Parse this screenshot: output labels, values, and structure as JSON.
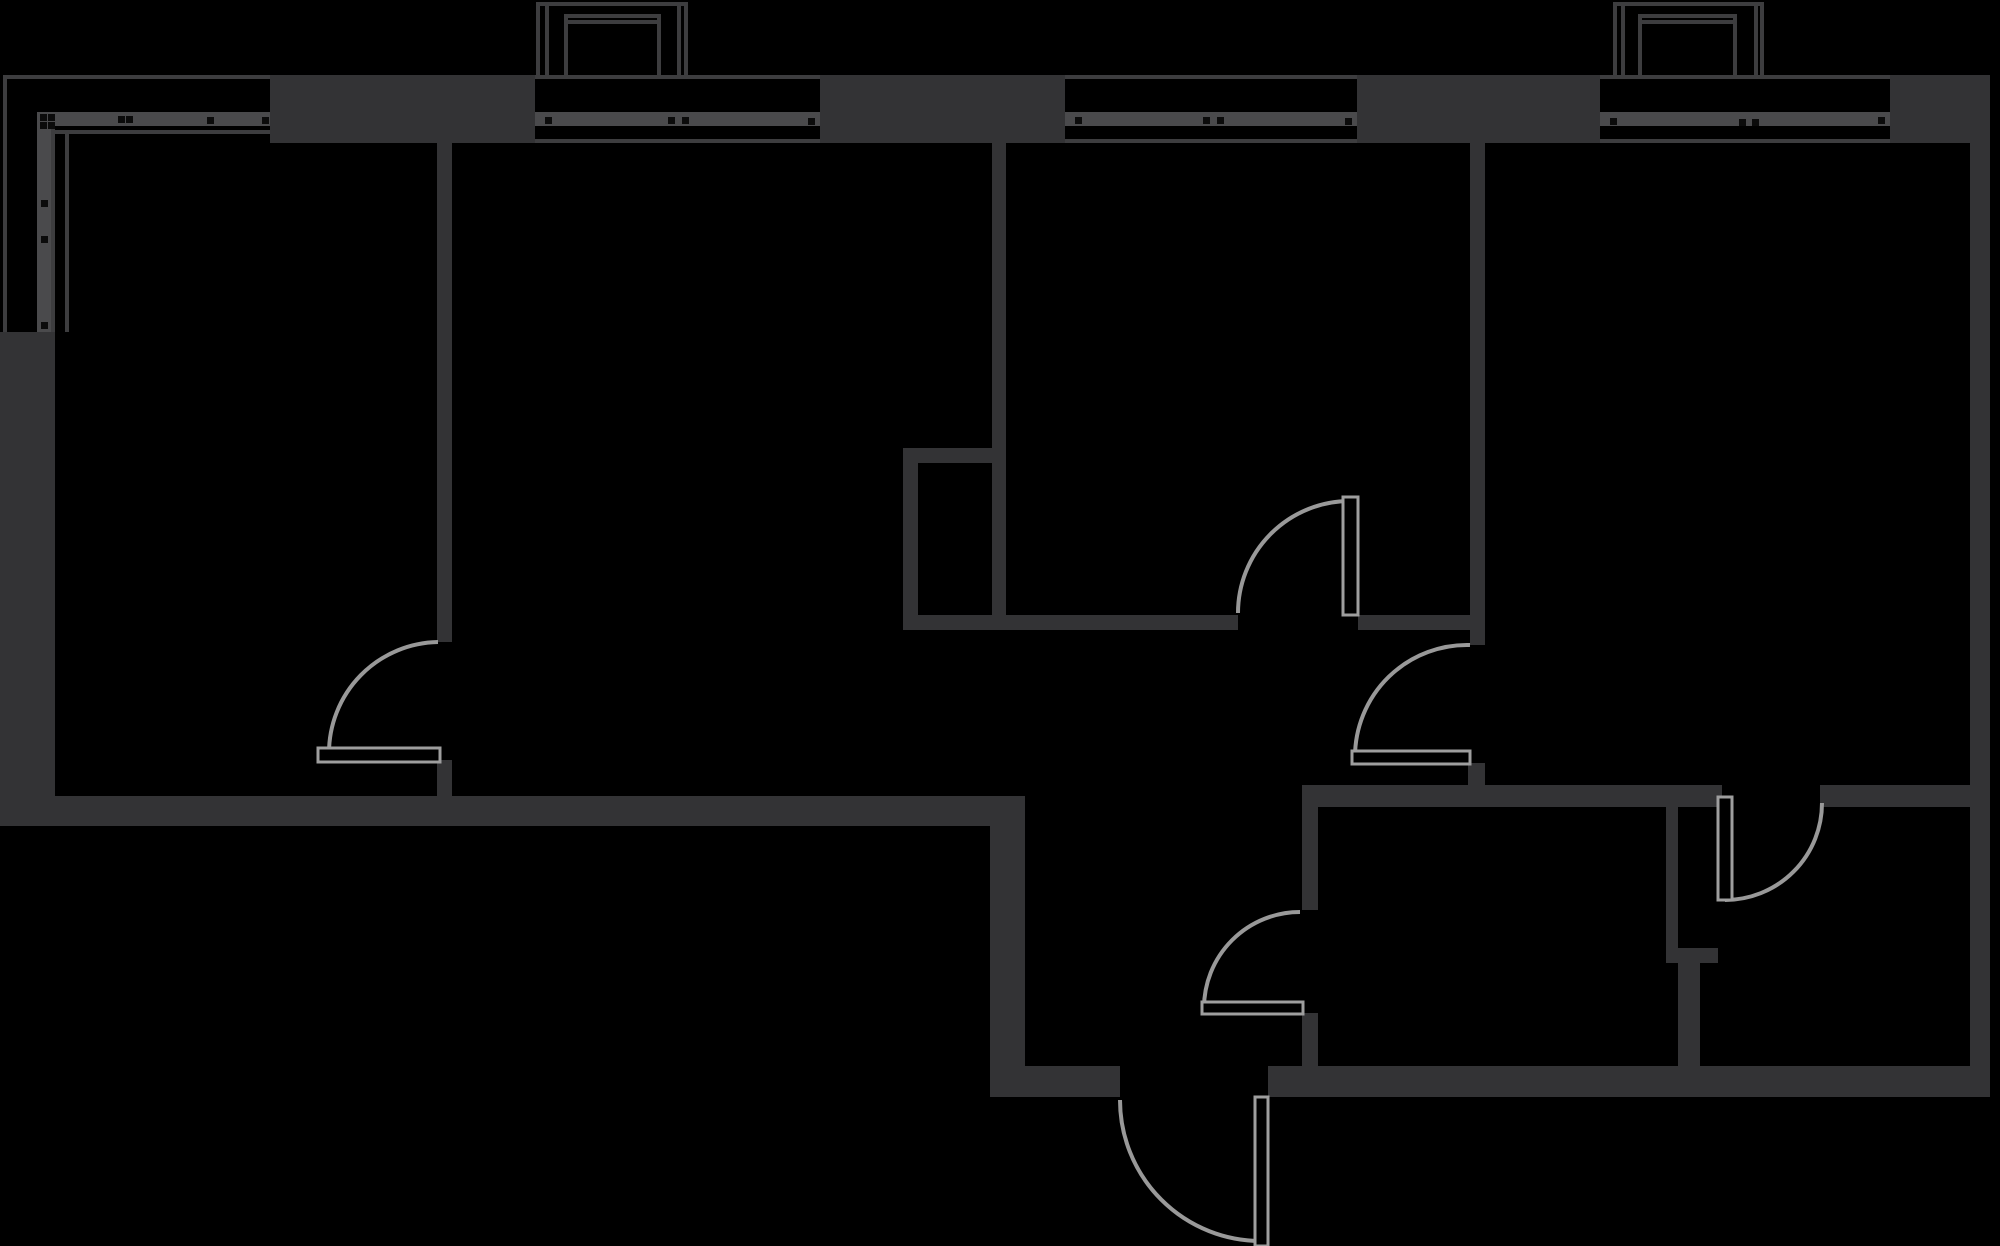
{
  "canvas": {
    "width": 2000,
    "height": 1246,
    "background": "#000000"
  },
  "palette": {
    "wall_fill": "#333335",
    "outline_line": "#3d3d3f",
    "glazing_bar": "#4a4a4c",
    "fixing_dot": "#0b0b0b",
    "door_symbol": "#9e9e9e",
    "door_arc": "#999999",
    "leaf_fill": "#000000"
  },
  "plan": {
    "outline_lines": [
      {
        "x": 3,
        "y": 75,
        "w": 1987,
        "h": 4
      },
      {
        "x": 3,
        "y": 75,
        "w": 4,
        "h": 257
      },
      {
        "x": 535,
        "y": 139,
        "w": 285,
        "h": 4
      },
      {
        "x": 1065,
        "y": 139,
        "w": 292,
        "h": 4
      },
      {
        "x": 1600,
        "y": 139,
        "w": 290,
        "h": 4
      },
      {
        "x": 51,
        "y": 130,
        "w": 219,
        "h": 4
      },
      {
        "x": 51,
        "y": 126,
        "w": 4,
        "h": 206
      },
      {
        "x": 65,
        "y": 134,
        "w": 4,
        "h": 198
      }
    ],
    "balcony_lines": [
      {
        "x": 536,
        "y": 2,
        "w": 152,
        "h": 4
      },
      {
        "x": 536,
        "y": 2,
        "w": 4,
        "h": 73
      },
      {
        "x": 545,
        "y": 2,
        "w": 4,
        "h": 73
      },
      {
        "x": 677,
        "y": 2,
        "w": 4,
        "h": 73
      },
      {
        "x": 684,
        "y": 2,
        "w": 4,
        "h": 73
      },
      {
        "x": 564,
        "y": 14,
        "w": 97,
        "h": 4
      },
      {
        "x": 564,
        "y": 20,
        "w": 97,
        "h": 4
      },
      {
        "x": 564,
        "y": 14,
        "w": 4,
        "h": 61
      },
      {
        "x": 657,
        "y": 14,
        "w": 4,
        "h": 61
      },
      {
        "x": 1613,
        "y": 2,
        "w": 151,
        "h": 4
      },
      {
        "x": 1613,
        "y": 2,
        "w": 4,
        "h": 73
      },
      {
        "x": 1621,
        "y": 2,
        "w": 4,
        "h": 73
      },
      {
        "x": 1754,
        "y": 2,
        "w": 4,
        "h": 73
      },
      {
        "x": 1760,
        "y": 2,
        "w": 4,
        "h": 73
      },
      {
        "x": 1638,
        "y": 14,
        "w": 99,
        "h": 4
      },
      {
        "x": 1638,
        "y": 20,
        "w": 99,
        "h": 4
      },
      {
        "x": 1638,
        "y": 14,
        "w": 4,
        "h": 61
      },
      {
        "x": 1733,
        "y": 14,
        "w": 4,
        "h": 61
      }
    ],
    "glazing_bars": [
      {
        "x": 37,
        "y": 112,
        "w": 233,
        "h": 14
      },
      {
        "x": 37,
        "y": 112,
        "w": 14,
        "h": 220
      },
      {
        "x": 535,
        "y": 112,
        "w": 285,
        "h": 14
      },
      {
        "x": 1065,
        "y": 112,
        "w": 292,
        "h": 14
      },
      {
        "x": 1600,
        "y": 112,
        "w": 290,
        "h": 14
      }
    ],
    "fixing_dots": [
      {
        "x": 40,
        "y": 114
      },
      {
        "x": 48,
        "y": 114
      },
      {
        "x": 40,
        "y": 122
      },
      {
        "x": 48,
        "y": 122
      },
      {
        "x": 118,
        "y": 116
      },
      {
        "x": 126,
        "y": 116
      },
      {
        "x": 207,
        "y": 117
      },
      {
        "x": 262,
        "y": 117
      },
      {
        "x": 41,
        "y": 200
      },
      {
        "x": 41,
        "y": 236
      },
      {
        "x": 41,
        "y": 322
      },
      {
        "x": 545,
        "y": 117
      },
      {
        "x": 668,
        "y": 117
      },
      {
        "x": 682,
        "y": 117
      },
      {
        "x": 808,
        "y": 118
      },
      {
        "x": 1075,
        "y": 117
      },
      {
        "x": 1203,
        "y": 117
      },
      {
        "x": 1217,
        "y": 117
      },
      {
        "x": 1345,
        "y": 118
      },
      {
        "x": 1610,
        "y": 118
      },
      {
        "x": 1739,
        "y": 119
      },
      {
        "x": 1752,
        "y": 119
      },
      {
        "x": 1878,
        "y": 117
      }
    ],
    "walls": [
      {
        "x": 0,
        "y": 332,
        "w": 55,
        "h": 494
      },
      {
        "x": 0,
        "y": 796,
        "w": 1025,
        "h": 30
      },
      {
        "x": 990,
        "y": 826,
        "w": 35,
        "h": 271
      },
      {
        "x": 270,
        "y": 75,
        "w": 265,
        "h": 68
      },
      {
        "x": 820,
        "y": 75,
        "w": 245,
        "h": 68
      },
      {
        "x": 1357,
        "y": 75,
        "w": 243,
        "h": 68
      },
      {
        "x": 1890,
        "y": 75,
        "w": 100,
        "h": 68
      },
      {
        "x": 437,
        "y": 143,
        "w": 15,
        "h": 499
      },
      {
        "x": 437,
        "y": 760,
        "w": 15,
        "h": 36
      },
      {
        "x": 992,
        "y": 143,
        "w": 14,
        "h": 487
      },
      {
        "x": 903,
        "y": 448,
        "w": 103,
        "h": 15
      },
      {
        "x": 903,
        "y": 448,
        "w": 15,
        "h": 182
      },
      {
        "x": 903,
        "y": 615,
        "w": 335,
        "h": 15
      },
      {
        "x": 1358,
        "y": 615,
        "w": 112,
        "h": 15
      },
      {
        "x": 1470,
        "y": 143,
        "w": 15,
        "h": 502
      },
      {
        "x": 1468,
        "y": 763,
        "w": 17,
        "h": 23
      },
      {
        "x": 1302,
        "y": 785,
        "w": 420,
        "h": 22
      },
      {
        "x": 1820,
        "y": 785,
        "w": 170,
        "h": 22
      },
      {
        "x": 1302,
        "y": 807,
        "w": 16,
        "h": 103
      },
      {
        "x": 1302,
        "y": 1013,
        "w": 16,
        "h": 53
      },
      {
        "x": 1666,
        "y": 807,
        "w": 12,
        "h": 141
      },
      {
        "x": 1666,
        "y": 948,
        "w": 52,
        "h": 15
      },
      {
        "x": 1678,
        "y": 963,
        "w": 22,
        "h": 103
      },
      {
        "x": 1025,
        "y": 1066,
        "w": 95,
        "h": 31
      },
      {
        "x": 1268,
        "y": 1066,
        "w": 722,
        "h": 31
      },
      {
        "x": 1970,
        "y": 75,
        "w": 20,
        "h": 1022
      }
    ],
    "door_leaves": [
      {
        "x": 318,
        "y": 748,
        "w": 122,
        "h": 14
      },
      {
        "x": 1343,
        "y": 497,
        "w": 15,
        "h": 118
      },
      {
        "x": 1352,
        "y": 751,
        "w": 118,
        "h": 13
      },
      {
        "x": 1718,
        "y": 797,
        "w": 14,
        "h": 103
      },
      {
        "x": 1202,
        "y": 1002,
        "w": 101,
        "h": 12
      },
      {
        "x": 1255,
        "y": 1097,
        "w": 13,
        "h": 149
      }
    ],
    "door_arcs": [
      {
        "d": "M438,642 A111,111 0 0 0 329,753"
      },
      {
        "d": "M1238,613 A112,112 0 0 1 1350,501"
      },
      {
        "d": "M1470,645 A112,112 0 0 0 1355,757"
      },
      {
        "d": "M1725,900 A97,97 0 0 0 1822,803"
      },
      {
        "d": "M1300,912 A96,96 0 0 0 1204,1008"
      },
      {
        "d": "M1120,1100 A141,141 0 0 0 1261,1241"
      }
    ]
  }
}
